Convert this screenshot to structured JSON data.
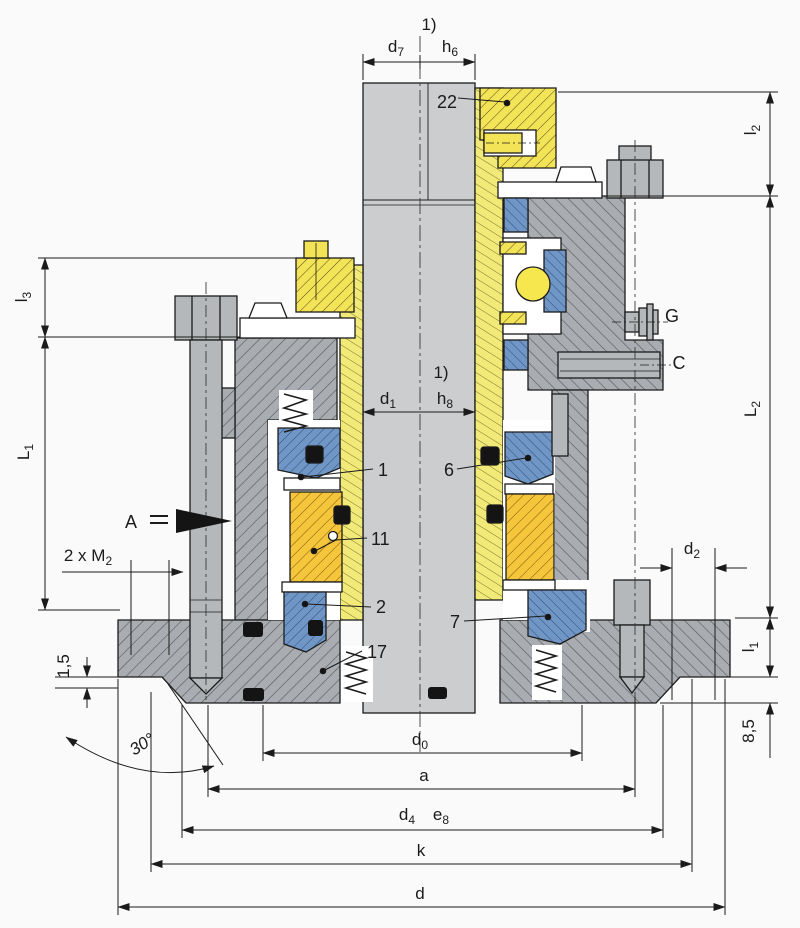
{
  "labels": {
    "note_top": "1)",
    "note_mid": "1)",
    "p22": "22",
    "p1": "1",
    "p2": "2",
    "p6": "6",
    "p7": "7",
    "p11": "11",
    "p17": "17",
    "view_a": "A",
    "port_g": "G",
    "port_c": "C"
  },
  "dims": {
    "d7": {
      "b": "d",
      "s": "7"
    },
    "h6": {
      "b": "h",
      "s": "6"
    },
    "d1": {
      "b": "d",
      "s": "1"
    },
    "h8": {
      "b": "h",
      "s": "8"
    },
    "l3": {
      "b": "l",
      "s": "3"
    },
    "L1": {
      "b": "L",
      "s": "1"
    },
    "l2": {
      "b": "l",
      "s": "2"
    },
    "L2": {
      "b": "L",
      "s": "2"
    },
    "m2": {
      "b": "2 x M",
      "s": "2"
    },
    "d2": {
      "b": "d",
      "s": "2"
    },
    "l1": {
      "b": "l",
      "s": "1"
    },
    "chamfer_angle": "30°",
    "recess": "1,5",
    "offset": "8,5",
    "d0": {
      "b": "d",
      "s": "0"
    },
    "a": "a",
    "d4": {
      "b": "d",
      "s": "4"
    },
    "e8": {
      "b": "e",
      "s": "8"
    },
    "k": "k",
    "d": "d"
  },
  "colors": {
    "shaft": "#cbcdcf",
    "housing": "#a9adb1",
    "sleeve": "#f1ea79",
    "collar": "#f3e356",
    "rotor": "#f5c53b",
    "seal_ring": "#7096c5",
    "oring": "#141414",
    "background": "#fafafa"
  }
}
